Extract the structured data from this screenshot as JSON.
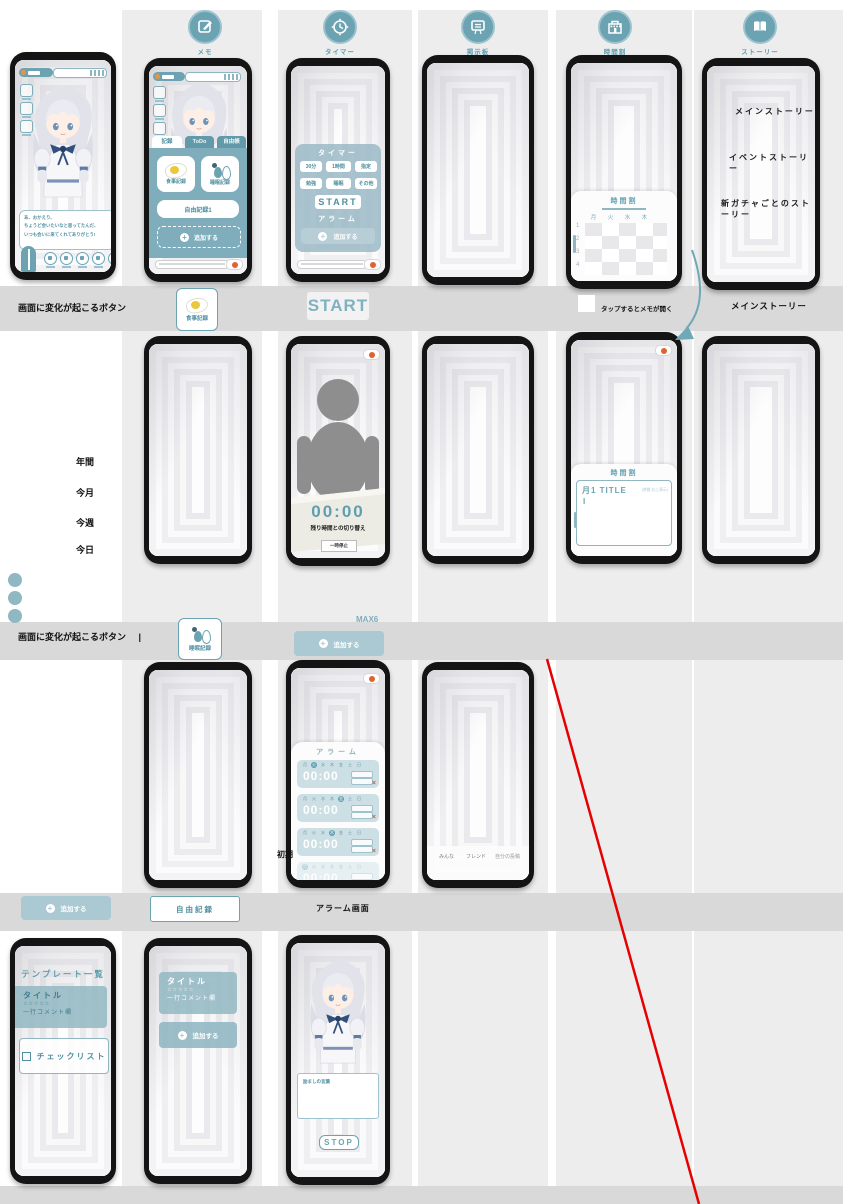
{
  "header": {
    "columns": [
      {
        "label": "メモ"
      },
      {
        "label": "タイマー"
      },
      {
        "label": "掲示板"
      },
      {
        "label": "時間割"
      },
      {
        "label": "ストーリー"
      }
    ]
  },
  "home": {
    "speech_line1": "あ、おかえり、",
    "speech_line2": "ちょうど会いたいなと思ってたんだ、",
    "speech_line3": "いつも会いに来てくれてありがとう!"
  },
  "memo": {
    "tabs": [
      "記録",
      "ToDo",
      "自由帳"
    ],
    "meal": "食事記録",
    "sleep": "睡眠記録",
    "free": "自由記録1",
    "add": "追加する"
  },
  "timer": {
    "title": "タイマー",
    "d30": "30分",
    "d60": "1時間",
    "dcustom": "指定",
    "study": "勉強",
    "sleep": "睡眠",
    "other": "その他",
    "start": "START",
    "alarm": "アラーム",
    "add": "追加する"
  },
  "timetable": {
    "title": "時間割",
    "days": [
      "月",
      "火",
      "水",
      "木"
    ],
    "periods": [
      "1",
      "2",
      "3",
      "4"
    ]
  },
  "story": {
    "items": [
      "メインストーリー",
      "イベントストーリー",
      "新ガチャごとのストーリー"
    ]
  },
  "band1": {
    "label": "画面に変化が起こるボタン",
    "meal": "食事記録",
    "start": "START",
    "note": "タップするとメモが開く",
    "story": "メインストーリー"
  },
  "row2": {
    "ranges": [
      "年間",
      "今月",
      "今週",
      "今日"
    ],
    "timer_time": "00:00",
    "timer_caption": "残り時間との切り替え",
    "pause": "一時停止",
    "tt_title": "時間割",
    "tt_entry": "月1 TITLE",
    "tt_note": "(時間 右に表示)"
  },
  "band2": {
    "label": "画面に変化が起こるボタン",
    "cursor": "|",
    "sleep": "睡眠記録",
    "max": "MAX6",
    "add": "追加する"
  },
  "row3": {
    "alarm_title": "アラーム",
    "alarm_time": "00:00",
    "days": [
      "月",
      "火",
      "水",
      "木",
      "金",
      "土",
      "日"
    ],
    "active_days": [
      1,
      4,
      3,
      0
    ],
    "delete": "×",
    "side_label": "初期",
    "board_tabs": [
      "みんな",
      "フレンド",
      "自分の投稿"
    ]
  },
  "band3": {
    "add": "追加する",
    "free": "自由記録",
    "caption": "アラーム画面"
  },
  "row4": {
    "template_title": "テンプレート一覧",
    "card_title": "タイトル",
    "card_stars": "☆☆☆☆☆",
    "card_comment": "一行コメント欄",
    "checklist": "チェックリスト",
    "add": "追加する",
    "cheer": "励ましの言葉",
    "stop": "STOP"
  },
  "colors": {
    "accent": "#6ba3b2",
    "band": "#d9d9d9",
    "red_line": "#e60000"
  }
}
